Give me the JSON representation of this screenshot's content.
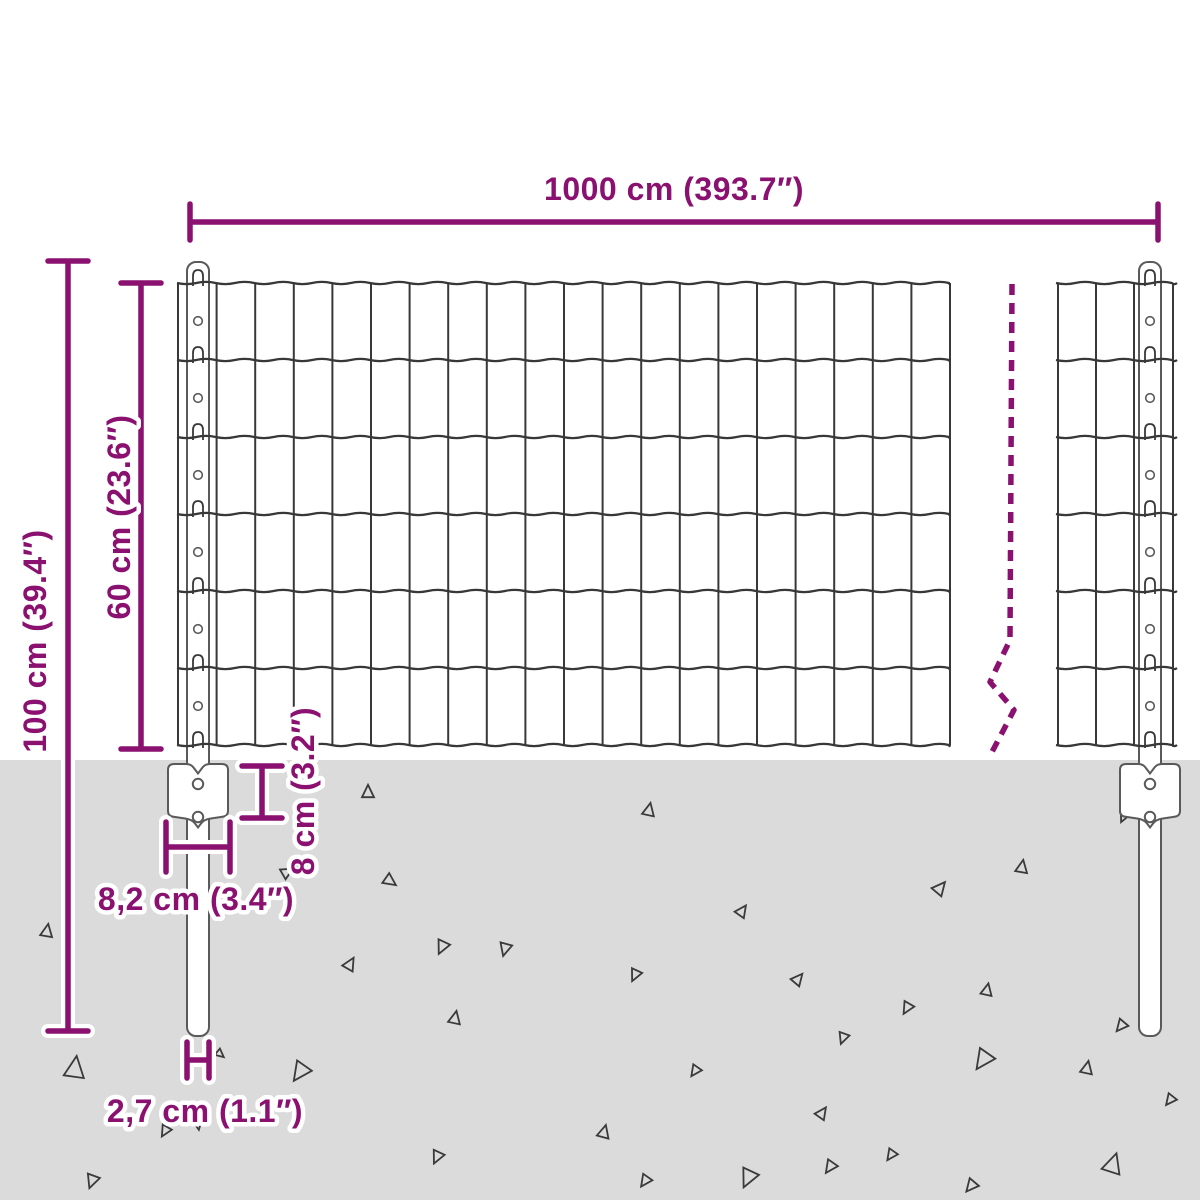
{
  "dimensions": {
    "total_width": "1000 cm (393.7″)",
    "total_height": "100 cm (39.4″)",
    "mesh_height": "60 cm (23.6″)",
    "anchor_depth": "8 cm (3.2″)",
    "anchor_width": "8,2 cm (3.4″)",
    "post_width": "2,7 cm (1.1″)"
  },
  "colors": {
    "accent": "#8A1170",
    "ground": "#DBDBDB",
    "wire": "#383838",
    "post_outline": "#5A5A5A",
    "debris": "#3A3A3A"
  }
}
